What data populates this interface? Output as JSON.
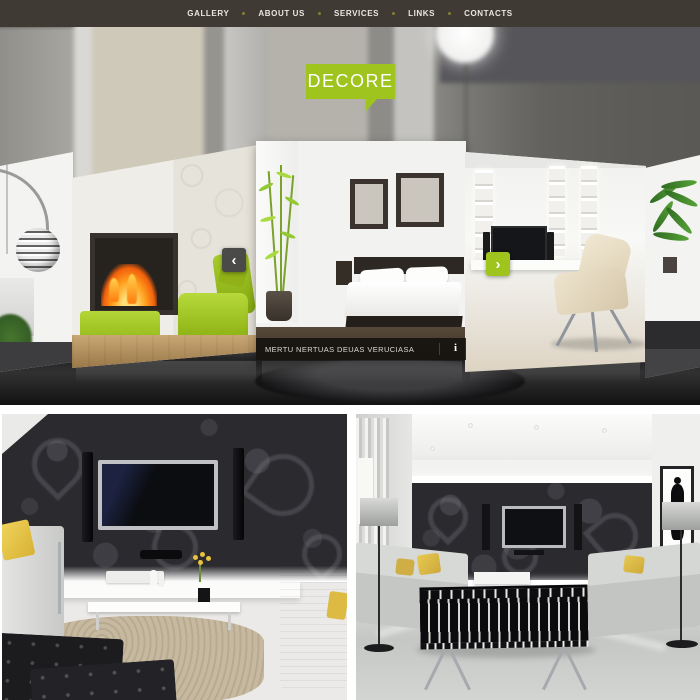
{
  "nav": {
    "items": [
      {
        "label": "GALLERY"
      },
      {
        "label": "ABOUT US"
      },
      {
        "label": "SERVICES"
      },
      {
        "label": "LINKS"
      },
      {
        "label": "CONTACTS"
      }
    ]
  },
  "logo": {
    "text": "DECORE"
  },
  "slider": {
    "caption": "MERTU NERTUAS DEUAS VERUCIASA",
    "prev_symbol": "‹",
    "next_symbol": "›",
    "info_symbol": "i"
  },
  "colors": {
    "accent_green": "#9ec41d",
    "nav_background": "#3f3a33",
    "caption_background": "rgba(18,16,13,0.85)",
    "nav_dot": "#7d8230"
  }
}
